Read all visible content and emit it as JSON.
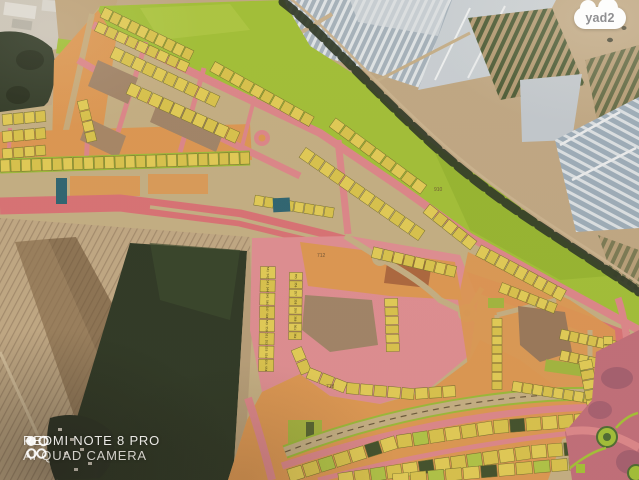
{
  "badge": {
    "label": "yad2"
  },
  "watermark": {
    "icon": "quad-camera-icon",
    "line1": "REDMI NOTE 8 PRO",
    "line2": "AI QUAD CAMERA"
  },
  "map": {
    "block_labels": [
      {
        "text": "712"
      },
      {
        "text": "718"
      },
      {
        "text": "910"
      }
    ],
    "parcel_number_columns": [
      {
        "values": [
          "541",
          "542",
          "543",
          "544",
          "545",
          "546",
          "547",
          "548",
          "549",
          "550",
          "551",
          "552",
          "553",
          "554",
          "555",
          "556"
        ]
      },
      {
        "values": [
          "355",
          "356",
          "357",
          "358",
          "359",
          "360",
          "361",
          "362"
        ]
      }
    ],
    "colors": {
      "open_space_green": "#a4c339",
      "open_space_green_dark": "#8fb12e",
      "parcel_yellow": "#e5cf58",
      "parcel_yellow_alt": "#dcc64e",
      "parcel_border": "#77722e",
      "chartreuse_cell": "#b2c748",
      "dark_cell": "#42522d",
      "road_pink": "#e0898d",
      "road_main_pink": "#dc7478",
      "road_khaki": "#c7b286",
      "zone_orange": "#e09a54",
      "vacant_brown": "#a3866a",
      "red_brown": "#a5603c",
      "public_teal": "#2e6674",
      "park_rose": "#c4707c",
      "park_purple": "#8a4f68",
      "aerial_tan": "#c3ab87",
      "aerial_field_green": "#2e3926",
      "tree_green": "#2f3a27",
      "greenhouse_gray": "#a9b6c0",
      "greenhouse_light": "#ccd3d8",
      "crop_row_green": "#4c5c36",
      "building_white": "#d9d6cd"
    }
  }
}
